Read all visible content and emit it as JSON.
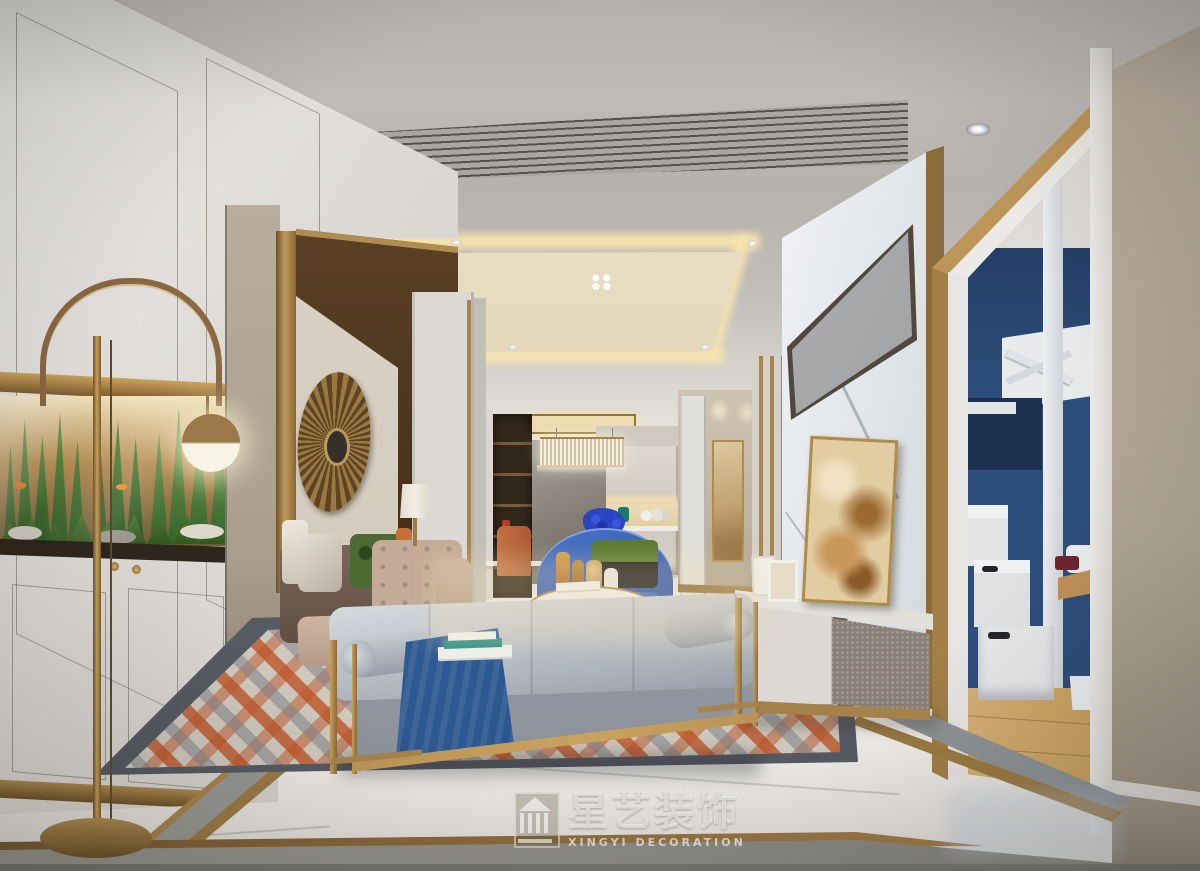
{
  "scene": {
    "description": "3D interior rendering of a modern luxe living-dining room with aquarium cabinet wall, gold sunburst decor, beige sofa, blue armchair, gray daybed bench, geometric rug, marble TV wall and a kids bedroom with bunk bed seen through a doorway"
  },
  "watermark": {
    "logo_icon": "pavilion-building-icon",
    "brand_cn": "星艺装饰",
    "brand_en": "XINGYI DECORATION"
  },
  "palette": {
    "ceiling": "#c6c2be",
    "cove": "#f6e4ae",
    "brass": "#a8844c",
    "brassdark": "#6e5228",
    "bronzewall": "#57401f",
    "beigewall": "#b3a897",
    "cabwhite": "#e3e0dc",
    "sofabeige": "#c4ab97",
    "chairblue": "#3a66bf",
    "orange": "#c0603a",
    "benchgray": "#b9bdc5",
    "throwblue": "#34649e",
    "rugorange": "#be5528",
    "rugborder": "#565a62",
    "floor": "#efede9",
    "bedroomblue": "#2c4e7c",
    "woodfloor": "#d2ab6e",
    "tvscreen": "#aeb0b2",
    "arttan": "#d9c29a",
    "plantgreen": "#4a7a34"
  }
}
